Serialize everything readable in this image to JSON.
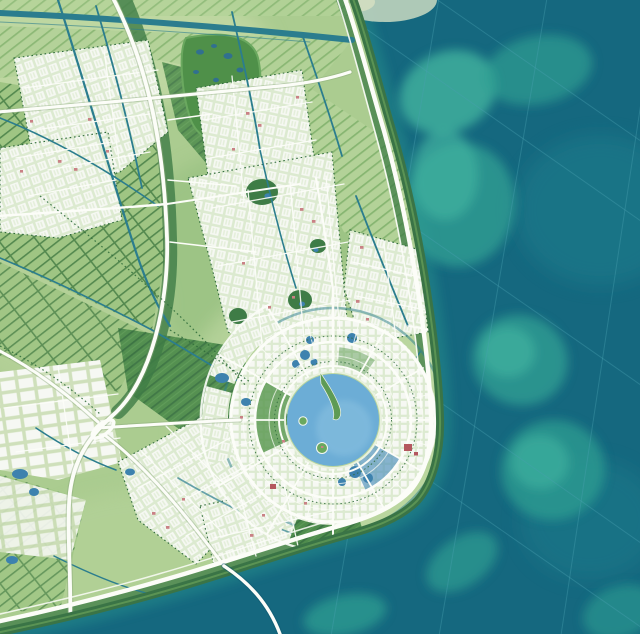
{
  "meta": {
    "description": "Aerial master-plan map of a coastal new town: circular central lake with ring-and-radial city, surrounding farmland grid with canals, wetland park, white arterial roads, seawall with coastal highway, teal sea with sandbars and a bridge running offshore",
    "map_type": "urban-masterplan-rendering",
    "visible_text": "none"
  },
  "palette": {
    "sea-deep": "#15687f",
    "sea-mid": "#1e7b8b",
    "shoal": "#2f9e92",
    "shoal-bright": "#41b39f",
    "cape": "#b6cfba",
    "cape-sand": "#cfdcc0",
    "land": "#abcc90",
    "land-light": "#c6dca8",
    "urban": "#dcead0",
    "bldg": "#f6f8f3",
    "pink": "#c98185",
    "red": "#b4575e",
    "road": "#fcfdf8",
    "forest": "#3e7c46",
    "forest-deep": "#2f6b3b",
    "field-dark": "#4f8c4d",
    "field-line": "#3b7343",
    "field-mid": "#9fc583",
    "field-stripe": "#54894f",
    "canal": "#2b7d8e",
    "lake": "#6cadd6",
    "lake-light": "#96c9e4",
    "pond": "#3d82ae",
    "tree": "#2f6b3a",
    "seagrid": "#49a0b0",
    "wall": "#3a7446",
    "green-wedge": "#5e9b55",
    "water-wedge": "#5795bd"
  },
  "lake": {
    "cx": 333,
    "cy": 420,
    "r": 46
  },
  "rings": {
    "inner": 54,
    "middle": 78,
    "outer": 102,
    "canal_ring": 112,
    "outer_arterial": 132,
    "spoke_count": 12
  },
  "sea": {
    "sandbar_count": 8,
    "survey_grid": true,
    "bridge": true
  },
  "features": [
    "circular-lake",
    "lake-islands",
    "lake-peninsula",
    "ring-city",
    "radial-spokes",
    "coastal-highway",
    "seawall",
    "sea-bridge",
    "offshore-sandbars",
    "sea-survey-grid",
    "wetland-park",
    "farmland-strips",
    "canal-network",
    "urban-districts",
    "interchange"
  ]
}
